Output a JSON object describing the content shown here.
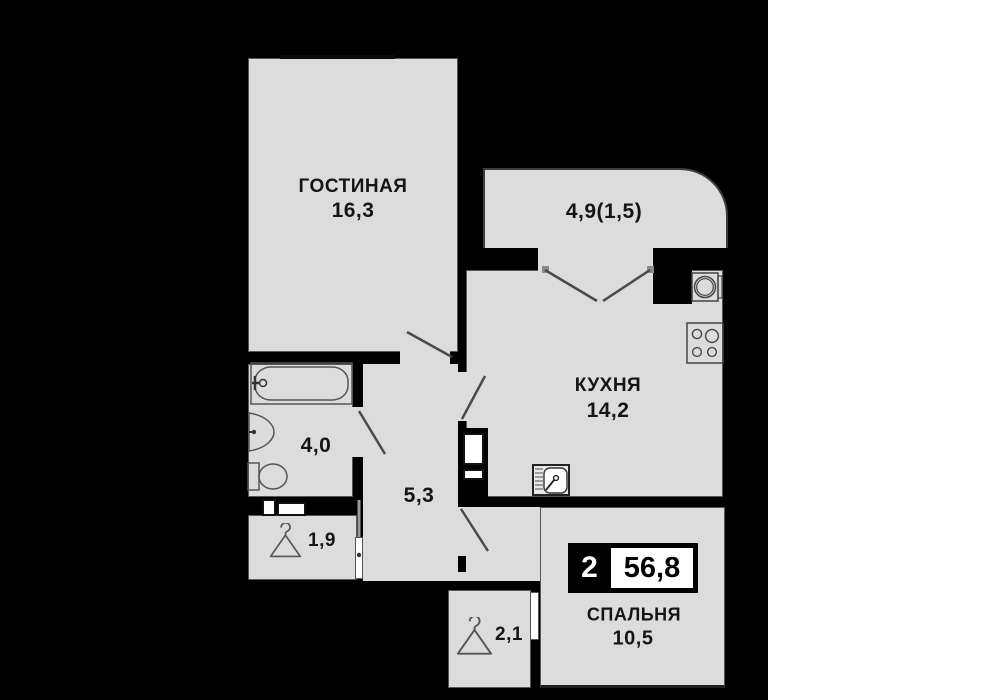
{
  "badge": {
    "rooms_count": "2",
    "total_area": "56,8"
  },
  "rooms": {
    "living": {
      "name": "ГОСТИНАЯ",
      "area": "16,3"
    },
    "balcony": {
      "area": "4,9(1,5)"
    },
    "kitchen": {
      "name": "КУХНЯ",
      "area": "14,2"
    },
    "bathroom": {
      "area": "4,0"
    },
    "hallway": {
      "area": "5,3"
    },
    "closet_small": {
      "area": "1,9"
    },
    "closet_entry": {
      "area": "2,1"
    },
    "bedroom": {
      "name": "СПАЛЬНЯ",
      "area": "10,5"
    }
  },
  "icons": {
    "bathtub": "bathtub-icon",
    "washbasin": "washbasin-icon",
    "toilet": "toilet-icon",
    "washing_machine": "washing-machine-icon",
    "stove": "stove-icon",
    "kitchen_sink": "kitchen-sink-icon",
    "hanger": "hanger-icon"
  },
  "colors": {
    "background": "#000000",
    "floor": "#dcdcdc",
    "line": "#4a4a4a",
    "text": "#151515",
    "badge_bg": "#000000",
    "badge_box": "#ffffff"
  }
}
